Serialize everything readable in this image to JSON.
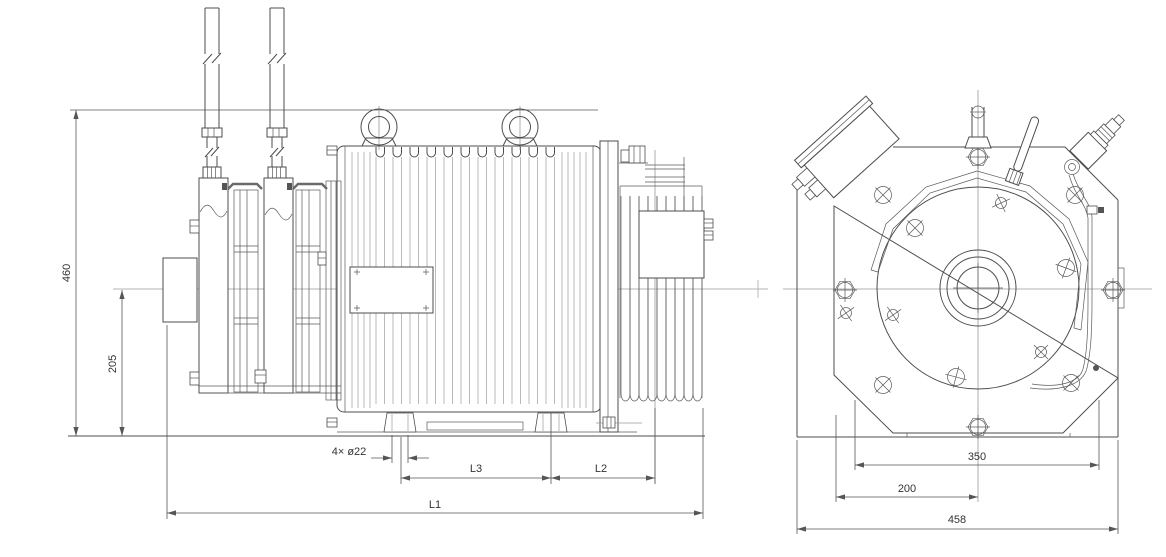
{
  "drawing": {
    "dimensions": {
      "overall_height": "460",
      "axis_height": "205",
      "foot_holes": "4× ø22",
      "l3": "L3",
      "l2": "L2",
      "l1": "L1",
      "front_foot_span": "350",
      "front_axis_offset": "200",
      "front_overall_width": "458"
    },
    "colors": {
      "line": "#4d4d4d",
      "light_line": "#b3b3b3",
      "background": "#ffffff",
      "text": "#333333"
    }
  }
}
